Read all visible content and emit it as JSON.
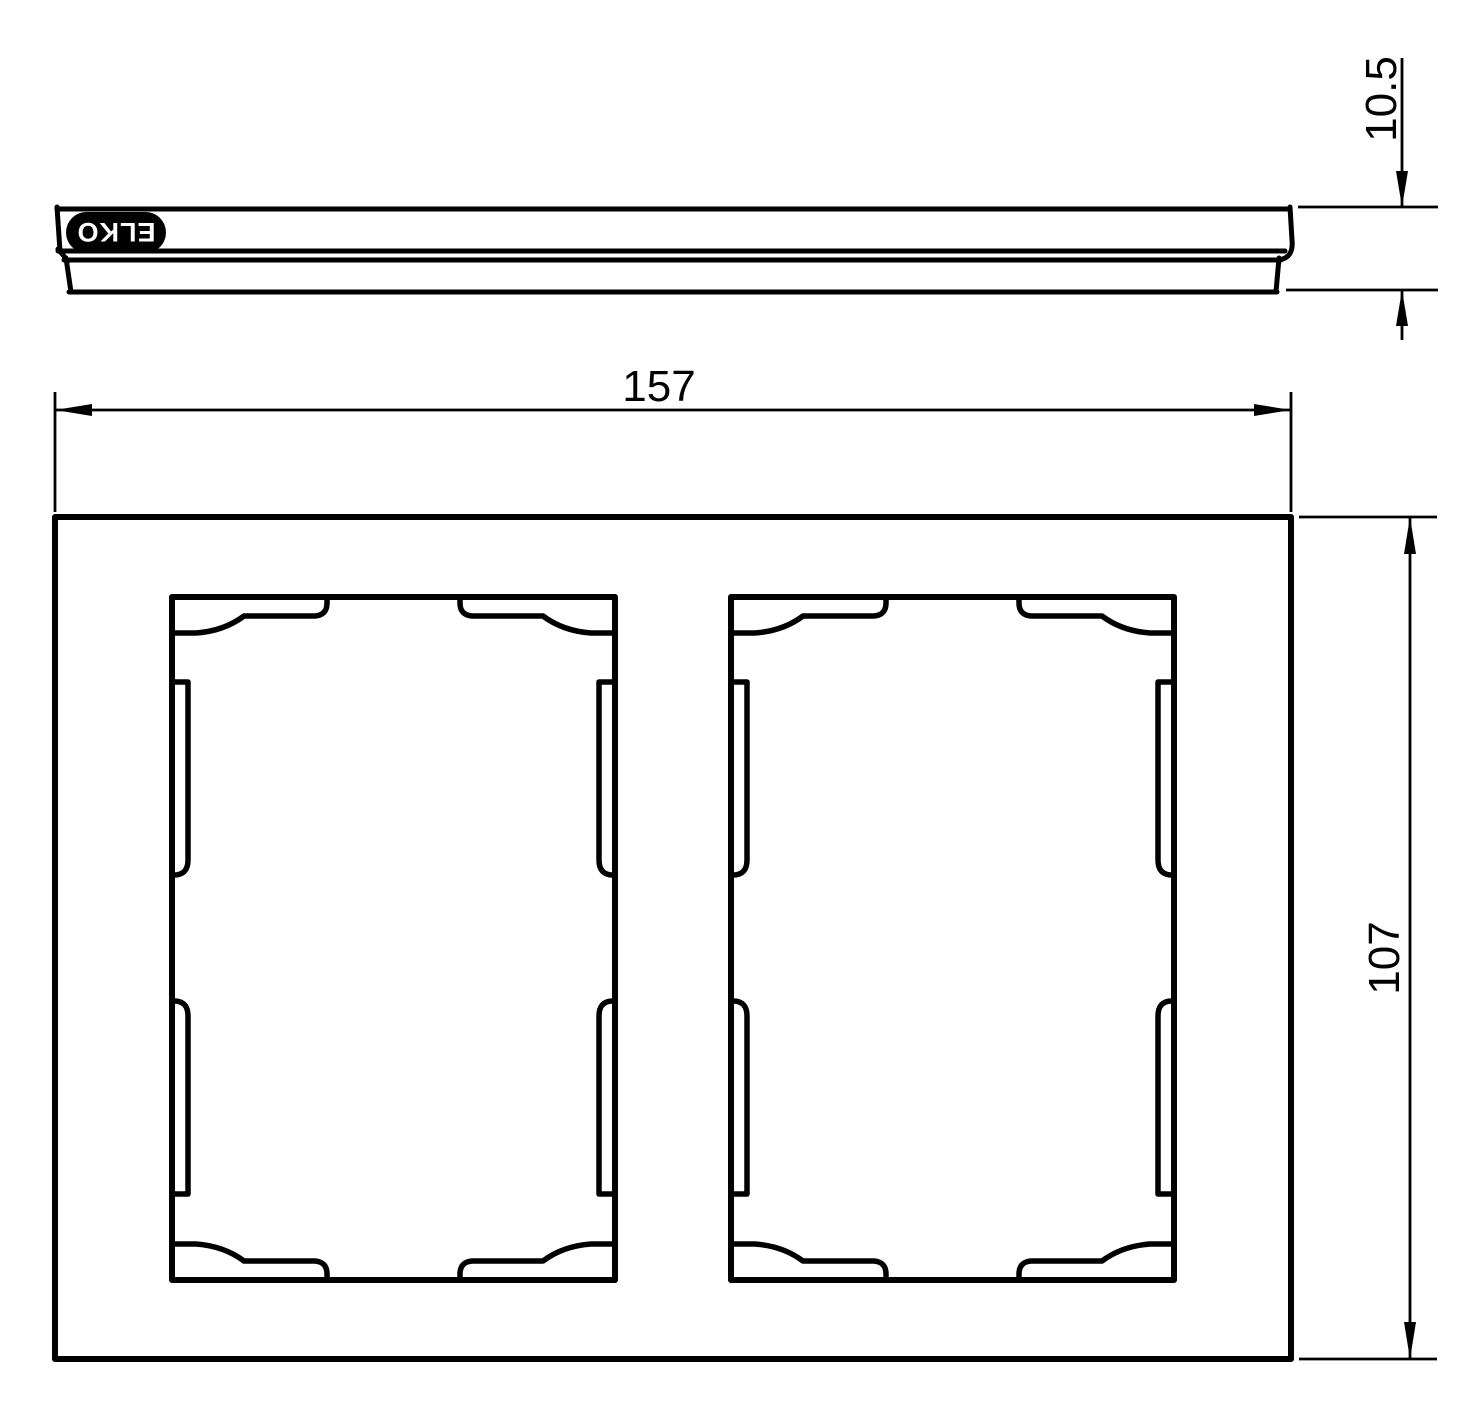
{
  "drawing": {
    "type": "technical-drawing",
    "background_color": "#ffffff",
    "line_color": "#000000",
    "views": {
      "side_view": {
        "name": "side profile view of frame",
        "brand_label": "ELKO",
        "depth_dimension": "10.5"
      },
      "front_view": {
        "name": "front view of 2-gang frame",
        "width_dimension": "157",
        "height_dimension": "107",
        "opening_count": 2
      }
    }
  }
}
